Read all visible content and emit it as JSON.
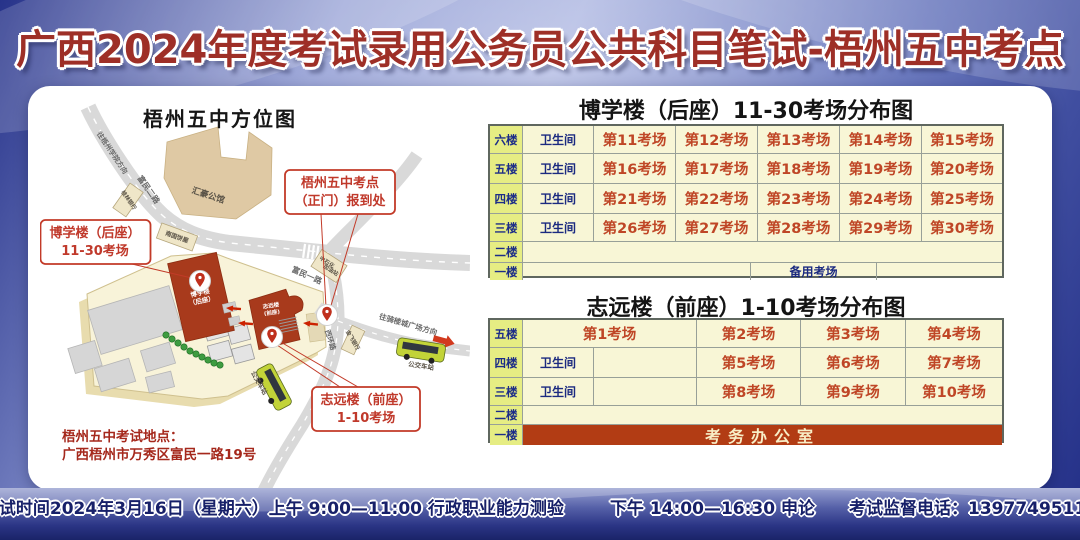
{
  "header": {
    "title": "广西2024年度考试录用公务员公共科目笔试-梧州五中考点"
  },
  "map": {
    "title": "梧州五中方位图",
    "address_label": "梧州五中考试地点：",
    "address": "广西梧州市万秀区富民一路19号",
    "roads": {
      "to_wuzhou_college": "往梧州学院方向",
      "fumin_2": "富民二路",
      "fumin_1": "富民一路",
      "xihuan": "西环路",
      "to_qilou": "往骑楼城广场方向"
    },
    "places": {
      "guilin_bank": "桂林银行",
      "huihao": "汇豪公馆",
      "bakery": "南国饼屋",
      "sinopec_1": "中石化",
      "sinopec_2": "加油站",
      "jinfei_bank": "金飞银行",
      "bus_stop": "公交车站"
    },
    "buildings": {
      "boxue_1": "博学楼",
      "boxue_2": "（后座）",
      "zhiyuan_1": "志远楼",
      "zhiyuan_2": "(前座)"
    },
    "callouts": {
      "gate": {
        "line1": "梧州五中考点",
        "line2": "（正门）报到处"
      },
      "boxue": {
        "line1": "博学楼（后座）",
        "line2": "11-30考场"
      },
      "zhiyuan": {
        "line1": "志远楼（前座）",
        "line2": "1-10考场"
      }
    }
  },
  "tables": [
    {
      "title": "博学楼（后座）11-30考场分布图",
      "rows": [
        {
          "floor": "六楼",
          "toilet": "卫生间",
          "rooms": [
            "第11考场",
            "第12考场",
            "第13考场",
            "第14考场",
            "第15考场"
          ]
        },
        {
          "floor": "五楼",
          "toilet": "卫生间",
          "rooms": [
            "第16考场",
            "第17考场",
            "第18考场",
            "第19考场",
            "第20考场"
          ]
        },
        {
          "floor": "四楼",
          "toilet": "卫生间",
          "rooms": [
            "第21考场",
            "第22考场",
            "第23考场",
            "第24考场",
            "第25考场"
          ]
        },
        {
          "floor": "三楼",
          "toilet": "卫生间",
          "rooms": [
            "第26考场",
            "第27考场",
            "第28考场",
            "第29考场",
            "第30考场"
          ]
        },
        {
          "floor": "二楼"
        },
        {
          "floor": "一楼",
          "spare": "备用考场"
        }
      ]
    },
    {
      "title": "志远楼（前座）1-10考场分布图",
      "rows": [
        {
          "floor": "五楼",
          "wide": "第1考场",
          "rooms": [
            "第2考场",
            "第3考场",
            "第4考场"
          ]
        },
        {
          "floor": "四楼",
          "toilet": "卫生间",
          "rooms": [
            "第5考场",
            "第6考场",
            "第7考场"
          ]
        },
        {
          "floor": "三楼",
          "toilet": "卫生间",
          "rooms": [
            "第8考场",
            "第9考场",
            "第10考场"
          ]
        },
        {
          "floor": "二楼"
        },
        {
          "floor": "一楼",
          "office": "考务办公室"
        }
      ]
    }
  ],
  "footer": {
    "morning": "考试时间2024年3月16日（星期六）上午 9:00—11:00 行政职业能力测验",
    "afternoon": "下午 14:00—16:30 申论",
    "phone": "考试监督电话：13977495118"
  },
  "colors": {
    "title_red": "#9e2f27",
    "room_red": "#bf4626",
    "navy": "#1b2a80",
    "floor_bg": "#e6ed83",
    "cell_bg": "#f8f6d6",
    "office_bg": "#b23c14",
    "building_red": "#a83a1c",
    "callout_red": "#c23a28",
    "bg_blue": "#5c6cb8"
  }
}
